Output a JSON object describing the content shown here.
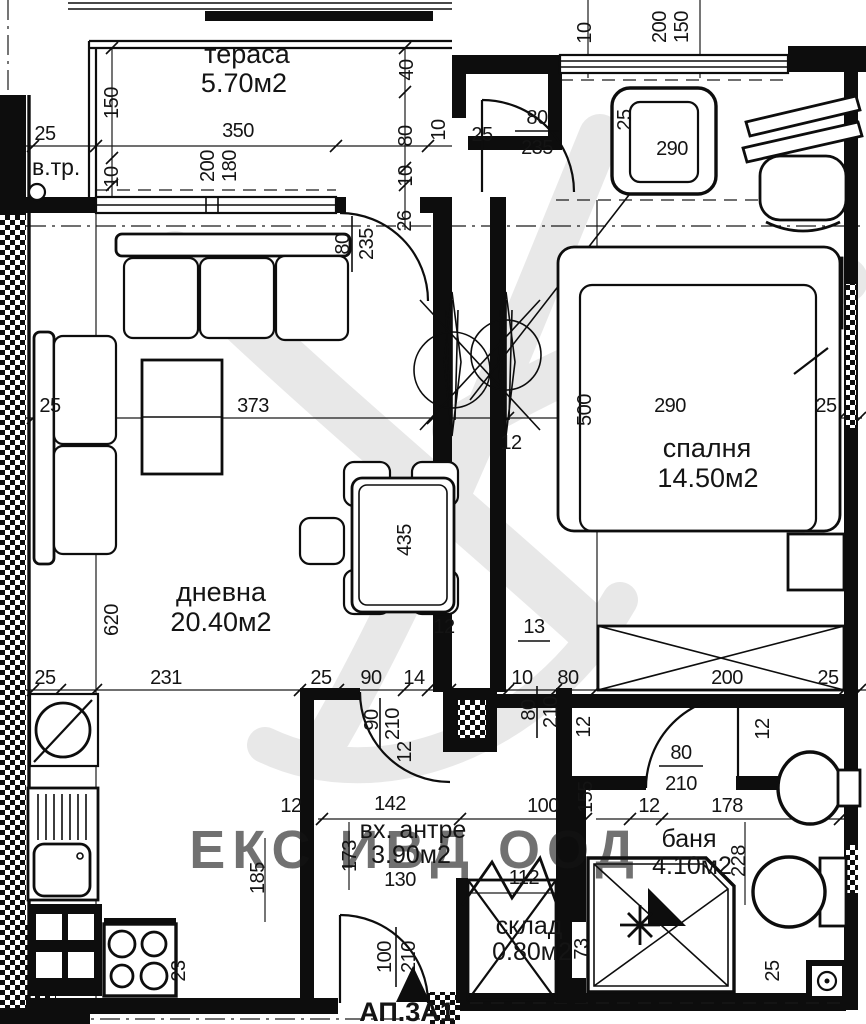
{
  "watermark": {
    "text": "ЕКС ИВД ООД",
    "color": "#bb3a45"
  },
  "footer": {
    "apartment_label": "АП.3А1"
  },
  "features": {
    "vent_label": "в.тр."
  },
  "rooms": {
    "terrace": {
      "name": "тераса",
      "area": "5.70м2"
    },
    "living": {
      "name": "дневна",
      "area": "20.40м2"
    },
    "bedroom": {
      "name": "спалня",
      "area": "14.50м2"
    },
    "hall": {
      "name": "вх. антре",
      "area": "3.90м2"
    },
    "bath": {
      "name": "баня",
      "area": "4.10м2"
    },
    "storage": {
      "name": "склад",
      "area": "0.80м2"
    }
  },
  "doors": {
    "bedroom": {
      "w": "80",
      "h": "235"
    },
    "terrace": {
      "w": "80",
      "h": "235"
    },
    "hall": {
      "w": "90",
      "h": "210"
    },
    "hall_inner": {
      "w": "80",
      "h": "210"
    },
    "bath": {
      "w": "80",
      "h": "210"
    },
    "entry": {
      "w": "100",
      "h": "210"
    }
  },
  "dims": {
    "t25": "25",
    "t150": "150",
    "t350": "350",
    "t10": "10",
    "t200": "200",
    "t180": "180",
    "r40": "40",
    "r80": "80",
    "r10": "10",
    "r26": "26",
    "r10b": "10",
    "u10": "10",
    "u200": "200",
    "u150": "150",
    "bd25": "25",
    "bd25v": "25",
    "bd290": "290",
    "m25": "25",
    "m373": "373",
    "m500": "500",
    "m12": "12",
    "m290": "290",
    "m25b": "25",
    "lv620": "620",
    "lv435": "435",
    "b25a": "25",
    "b231": "231",
    "b25b": "25",
    "b90": "90",
    "b14": "14",
    "b10": "10",
    "b80": "80",
    "b200": "200",
    "b25c": "25",
    "w13": "13",
    "w12": "12",
    "c12a": "12",
    "c12b": "12",
    "k100": "100",
    "k155": "155",
    "k12": "12",
    "k178": "178",
    "h142": "142",
    "h12": "12",
    "h173": "173",
    "h130": "130",
    "h185": "185",
    "s112": "112",
    "s73": "73",
    "s228": "228",
    "s25": "25",
    "s23": "23"
  }
}
